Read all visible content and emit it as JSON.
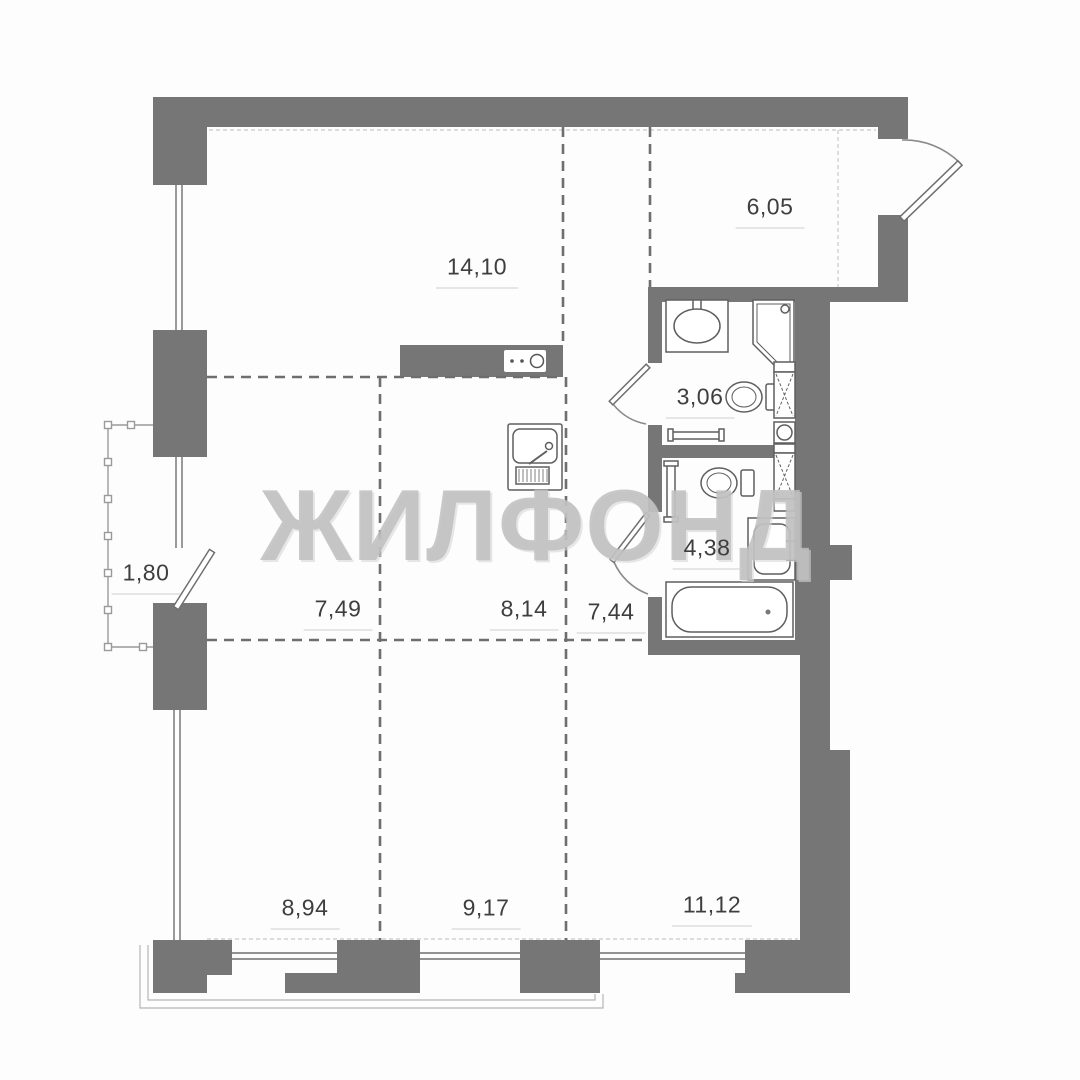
{
  "watermark": "ЖИЛФОНД",
  "rooms": [
    {
      "name": "living-kitchen",
      "area": "14,10"
    },
    {
      "name": "entry-hall",
      "area": "6,05"
    },
    {
      "name": "bathroom-upper",
      "area": "3,06"
    },
    {
      "name": "bathroom-lower",
      "area": "4,38"
    },
    {
      "name": "balcony",
      "area": "1,80"
    },
    {
      "name": "room-left",
      "area": "7,49"
    },
    {
      "name": "room-middle",
      "area": "8,14"
    },
    {
      "name": "hallway",
      "area": "7,44"
    },
    {
      "name": "bedroom-left",
      "area": "8,94"
    },
    {
      "name": "bedroom-middle",
      "area": "9,17"
    },
    {
      "name": "bedroom-right",
      "area": "11,12"
    }
  ],
  "icons": [
    "kitchen-sink",
    "cooktop",
    "wash-basin",
    "shower-cabin",
    "toilet",
    "bathtub",
    "washer-column",
    "towel-rail",
    "towel-radiator",
    "door-leaf",
    "door-arc",
    "balcony-railing"
  ],
  "colors": {
    "wall": "#767676",
    "partition_dash": "#6e6e6e",
    "fixture_line": "#5f5f5f",
    "label_text": "#3e3e3e",
    "watermark": "#bebebe",
    "thin_line": "#b5b5b5"
  }
}
